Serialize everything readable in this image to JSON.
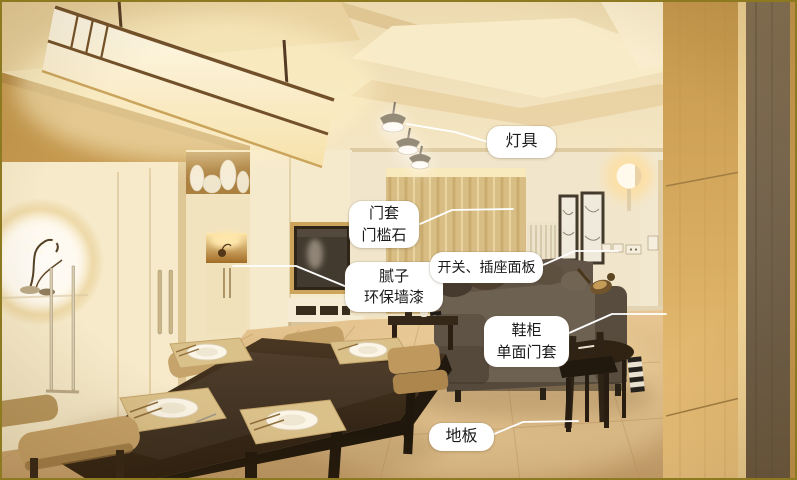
{
  "meta": {
    "type": "annotated-interior-photo",
    "scene": "Modern Japanese-style living and dining room renovation photo with callout labels",
    "width_px": 797,
    "height_px": 480
  },
  "colors": {
    "label_background": "#ffffff",
    "label_text": "#1b1b1b",
    "leader_line": "#ffffff",
    "photo_border": "#8d7a20"
  },
  "labels": {
    "lighting": {
      "line1": "灯具"
    },
    "door_frame": {
      "line1": "门套",
      "line2": "门槛石"
    },
    "wall_putty": {
      "line1": "腻子",
      "line2": "环保墙漆"
    },
    "switch_socket": {
      "line1": "开关、插座面板"
    },
    "shoe_cabinet": {
      "line1": "鞋柜",
      "line2": "单面门套"
    },
    "floor": {
      "line1": "地板"
    }
  }
}
